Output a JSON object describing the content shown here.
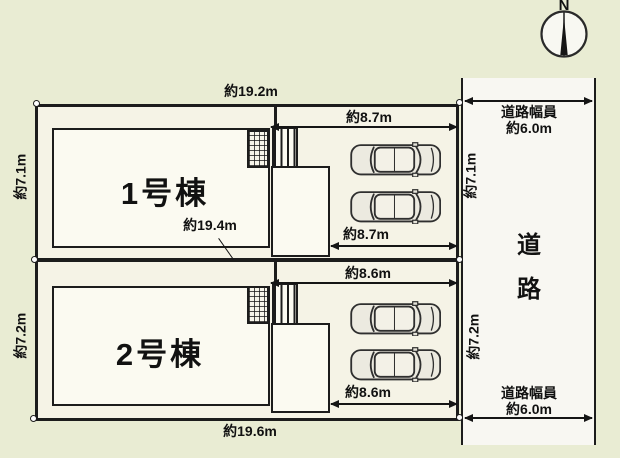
{
  "compass": {
    "north_label": "N"
  },
  "dimensions": {
    "top_width": "約19.2m",
    "middle_width": "約19.4m",
    "bottom_width": "約19.6m"
  },
  "units": [
    {
      "name": "1号棟",
      "depth_left": "約7.1m",
      "depth_right": "約7.1m",
      "parking_width_top": "約8.7m",
      "parking_width_bottom": "約8.7m",
      "parked_cars": 2
    },
    {
      "name": "2号棟",
      "depth_left": "約7.2m",
      "depth_right": "約7.2m",
      "parking_width_top": "約8.6m",
      "parking_width_bottom": "約8.6m",
      "parked_cars": 2
    }
  ],
  "road": {
    "name": "道路",
    "width_caption_line1": "道路幅員",
    "width_caption_line2": "約6.0m"
  },
  "colors": {
    "background": "#e9ecd3",
    "parcel_fill": "#f5f3e6",
    "surface_fill": "#fbfaf1",
    "road_fill": "#f8f7f2",
    "line": "#1c1c1c"
  }
}
